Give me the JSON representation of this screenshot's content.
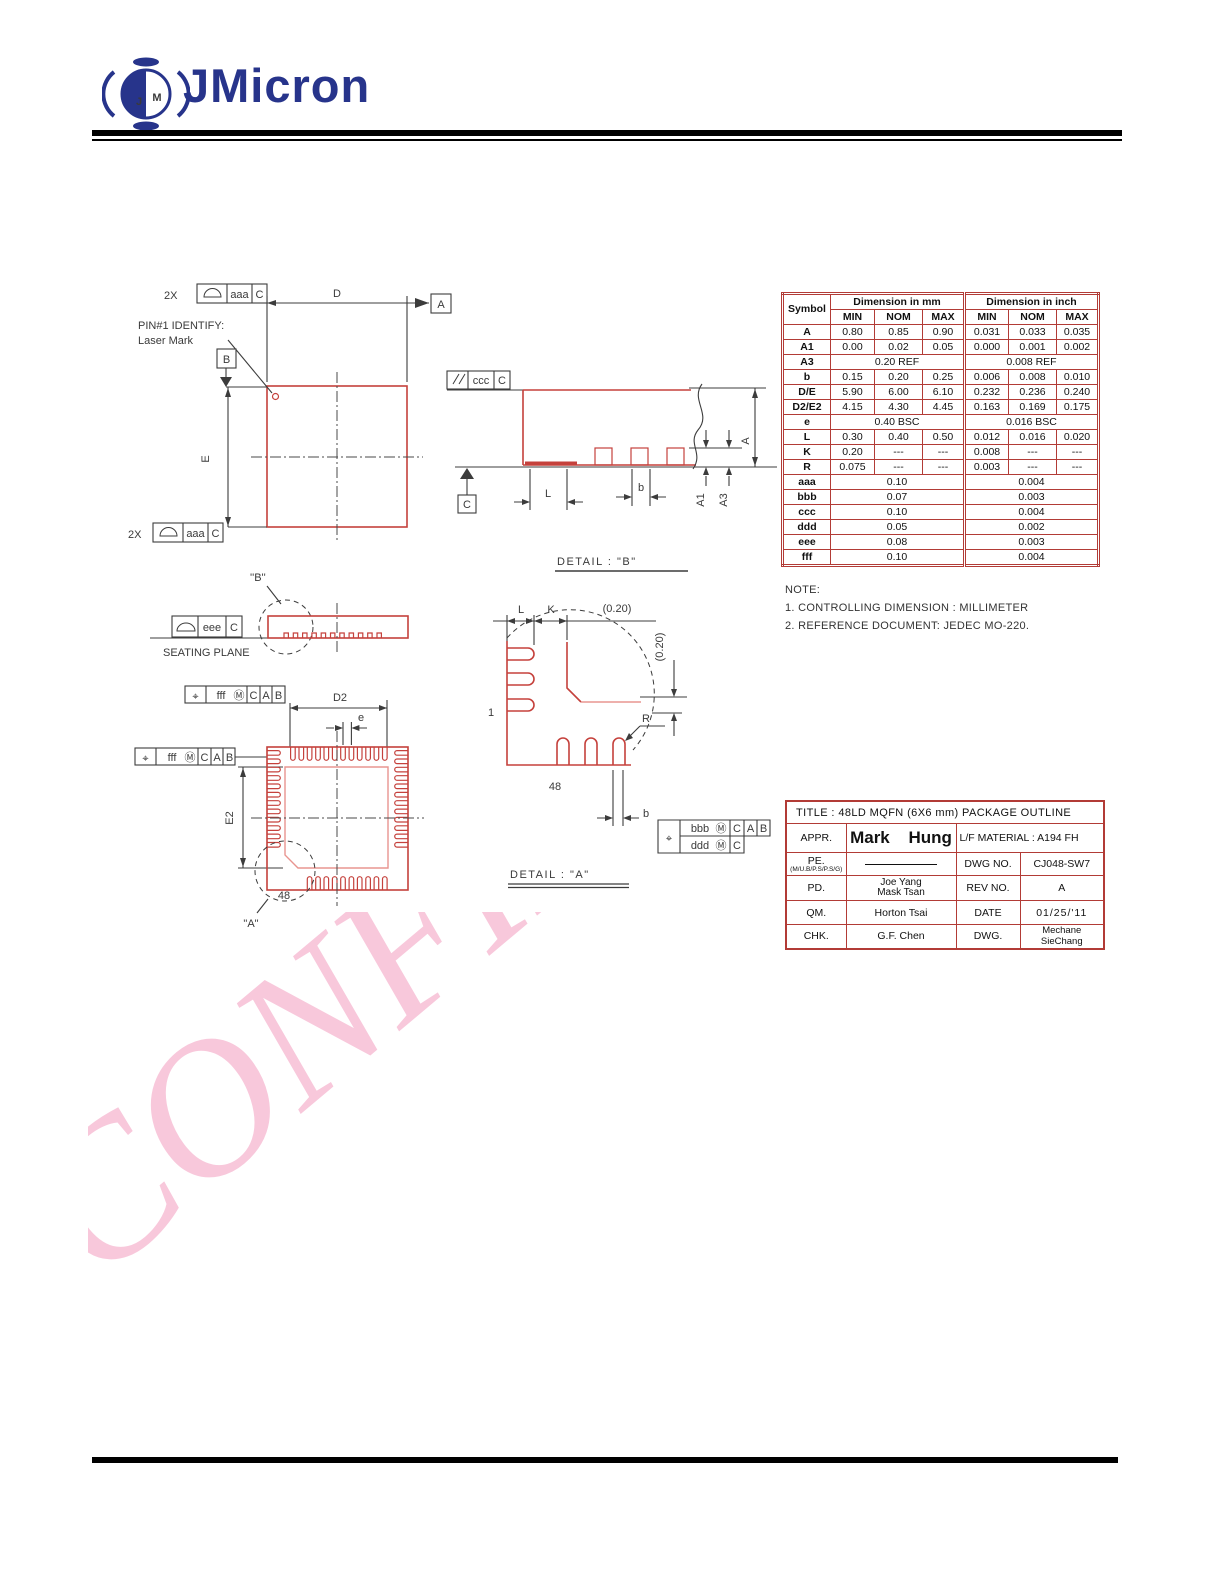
{
  "header": {
    "brand": "JMicron",
    "logo_j": "J",
    "logo_m": "M"
  },
  "watermark": {
    "text": "CONFIDENTIAL"
  },
  "dim_table": {
    "h_symbol": "Symbol",
    "h_mm": "Dimension  in  mm",
    "h_inch": "Dimension  in  inch",
    "h_min": "MIN",
    "h_nom": "NOM",
    "h_max": "MAX",
    "rows": [
      [
        "A",
        "0.80",
        "0.85",
        "0.90",
        "0.031",
        "0.033",
        "0.035"
      ],
      [
        "A1",
        "0.00",
        "0.02",
        "0.05",
        "0.000",
        "0.001",
        "0.002"
      ],
      [
        "A3",
        "0.20 REF",
        "0.008 REF"
      ],
      [
        "b",
        "0.15",
        "0.20",
        "0.25",
        "0.006",
        "0.008",
        "0.010"
      ],
      [
        "D/E",
        "5.90",
        "6.00",
        "6.10",
        "0.232",
        "0.236",
        "0.240"
      ],
      [
        "D2/E2",
        "4.15",
        "4.30",
        "4.45",
        "0.163",
        "0.169",
        "0.175"
      ],
      [
        "e",
        "0.40 BSC",
        "0.016 BSC"
      ],
      [
        "L",
        "0.30",
        "0.40",
        "0.50",
        "0.012",
        "0.016",
        "0.020"
      ],
      [
        "K",
        "0.20",
        "---",
        "---",
        "0.008",
        "---",
        "---"
      ],
      [
        "R",
        "0.075",
        "---",
        "---",
        "0.003",
        "---",
        "---"
      ],
      [
        "aaa",
        "0.10",
        "0.004"
      ],
      [
        "bbb",
        "0.07",
        "0.003"
      ],
      [
        "ccc",
        "0.10",
        "0.004"
      ],
      [
        "ddd",
        "0.05",
        "0.002"
      ],
      [
        "eee",
        "0.08",
        "0.003"
      ],
      [
        "fff",
        "0.10",
        "0.004"
      ]
    ]
  },
  "notes": {
    "heading": "NOTE:",
    "n1": "1. CONTROLLING DIMENSION : MILLIMETER",
    "n2": "2. REFERENCE DOCUMENT: JEDEC MO-220."
  },
  "title_block": {
    "title": "TITLE : 48LD MQFN (6X6 mm) PACKAGE OUTLINE",
    "appr_label": "APPR.",
    "appr_value": "Mark Hung",
    "lf_material": "L/F MATERIAL : A194 FH",
    "pe_label": "PE.",
    "pe_sub": "(M/U.B/P.S/P.S/G)",
    "dwg_no_label": "DWG NO.",
    "dwg_no_value": "CJ048-SW7",
    "pd_label": "PD.",
    "pd_value_line1": "Joe Yang",
    "pd_value_line2": "Mask Tsan",
    "rev_label": "REV NO.",
    "rev_value": "A",
    "qm_label": "QM.",
    "qm_value": "Horton Tsai",
    "date_label": "DATE",
    "date_value": "01/25/'11",
    "chk_label": "CHK.",
    "chk_value": "G.F. Chen",
    "dwg_label": "DWG.",
    "dwg_value": "Mechane SieChang"
  },
  "drawings": {
    "top_view": {
      "qty": "2X",
      "aaa": "aaa",
      "c": "C",
      "d_label": "D",
      "datum_a": "A",
      "datum_b": "B",
      "e_label": "E",
      "pin1_l1": "PIN#1  IDENTIFY:",
      "pin1_l2": "Laser  Mark"
    },
    "side_view": {
      "ccc": "ccc",
      "c": "C",
      "datum_c": "C",
      "l_label": "L",
      "b_label": "b",
      "a1_label": "A1",
      "a3_label": "A3",
      "a_label": "A",
      "detail_title": "DETAIL  :  \"B\""
    },
    "seating_view": {
      "eee": "eee",
      "c": "C",
      "caption": "SEATING  PLANE",
      "ref": "''B''"
    },
    "bottom_view": {
      "pos": "⌖",
      "fff": "fff",
      "mod": "Ⓜ",
      "c": "C",
      "a": "A",
      "b": "B",
      "d2_label": "D2",
      "e_label": "e",
      "e2_label": "E2",
      "pin48": "48",
      "ref": "\"A\""
    },
    "detail_a": {
      "l_label": "L",
      "k_label": "K",
      "ref_h": "(0.20)",
      "ref_v": "(0.20)",
      "r_label": "R",
      "pin1": "1",
      "pin48": "48",
      "b_label": "b",
      "pos": "⌖",
      "bbb": "bbb",
      "ddd": "ddd",
      "mod": "Ⓜ",
      "c": "C",
      "a": "A",
      "b": "B",
      "title": "DETAIL  :  \"A\""
    }
  }
}
